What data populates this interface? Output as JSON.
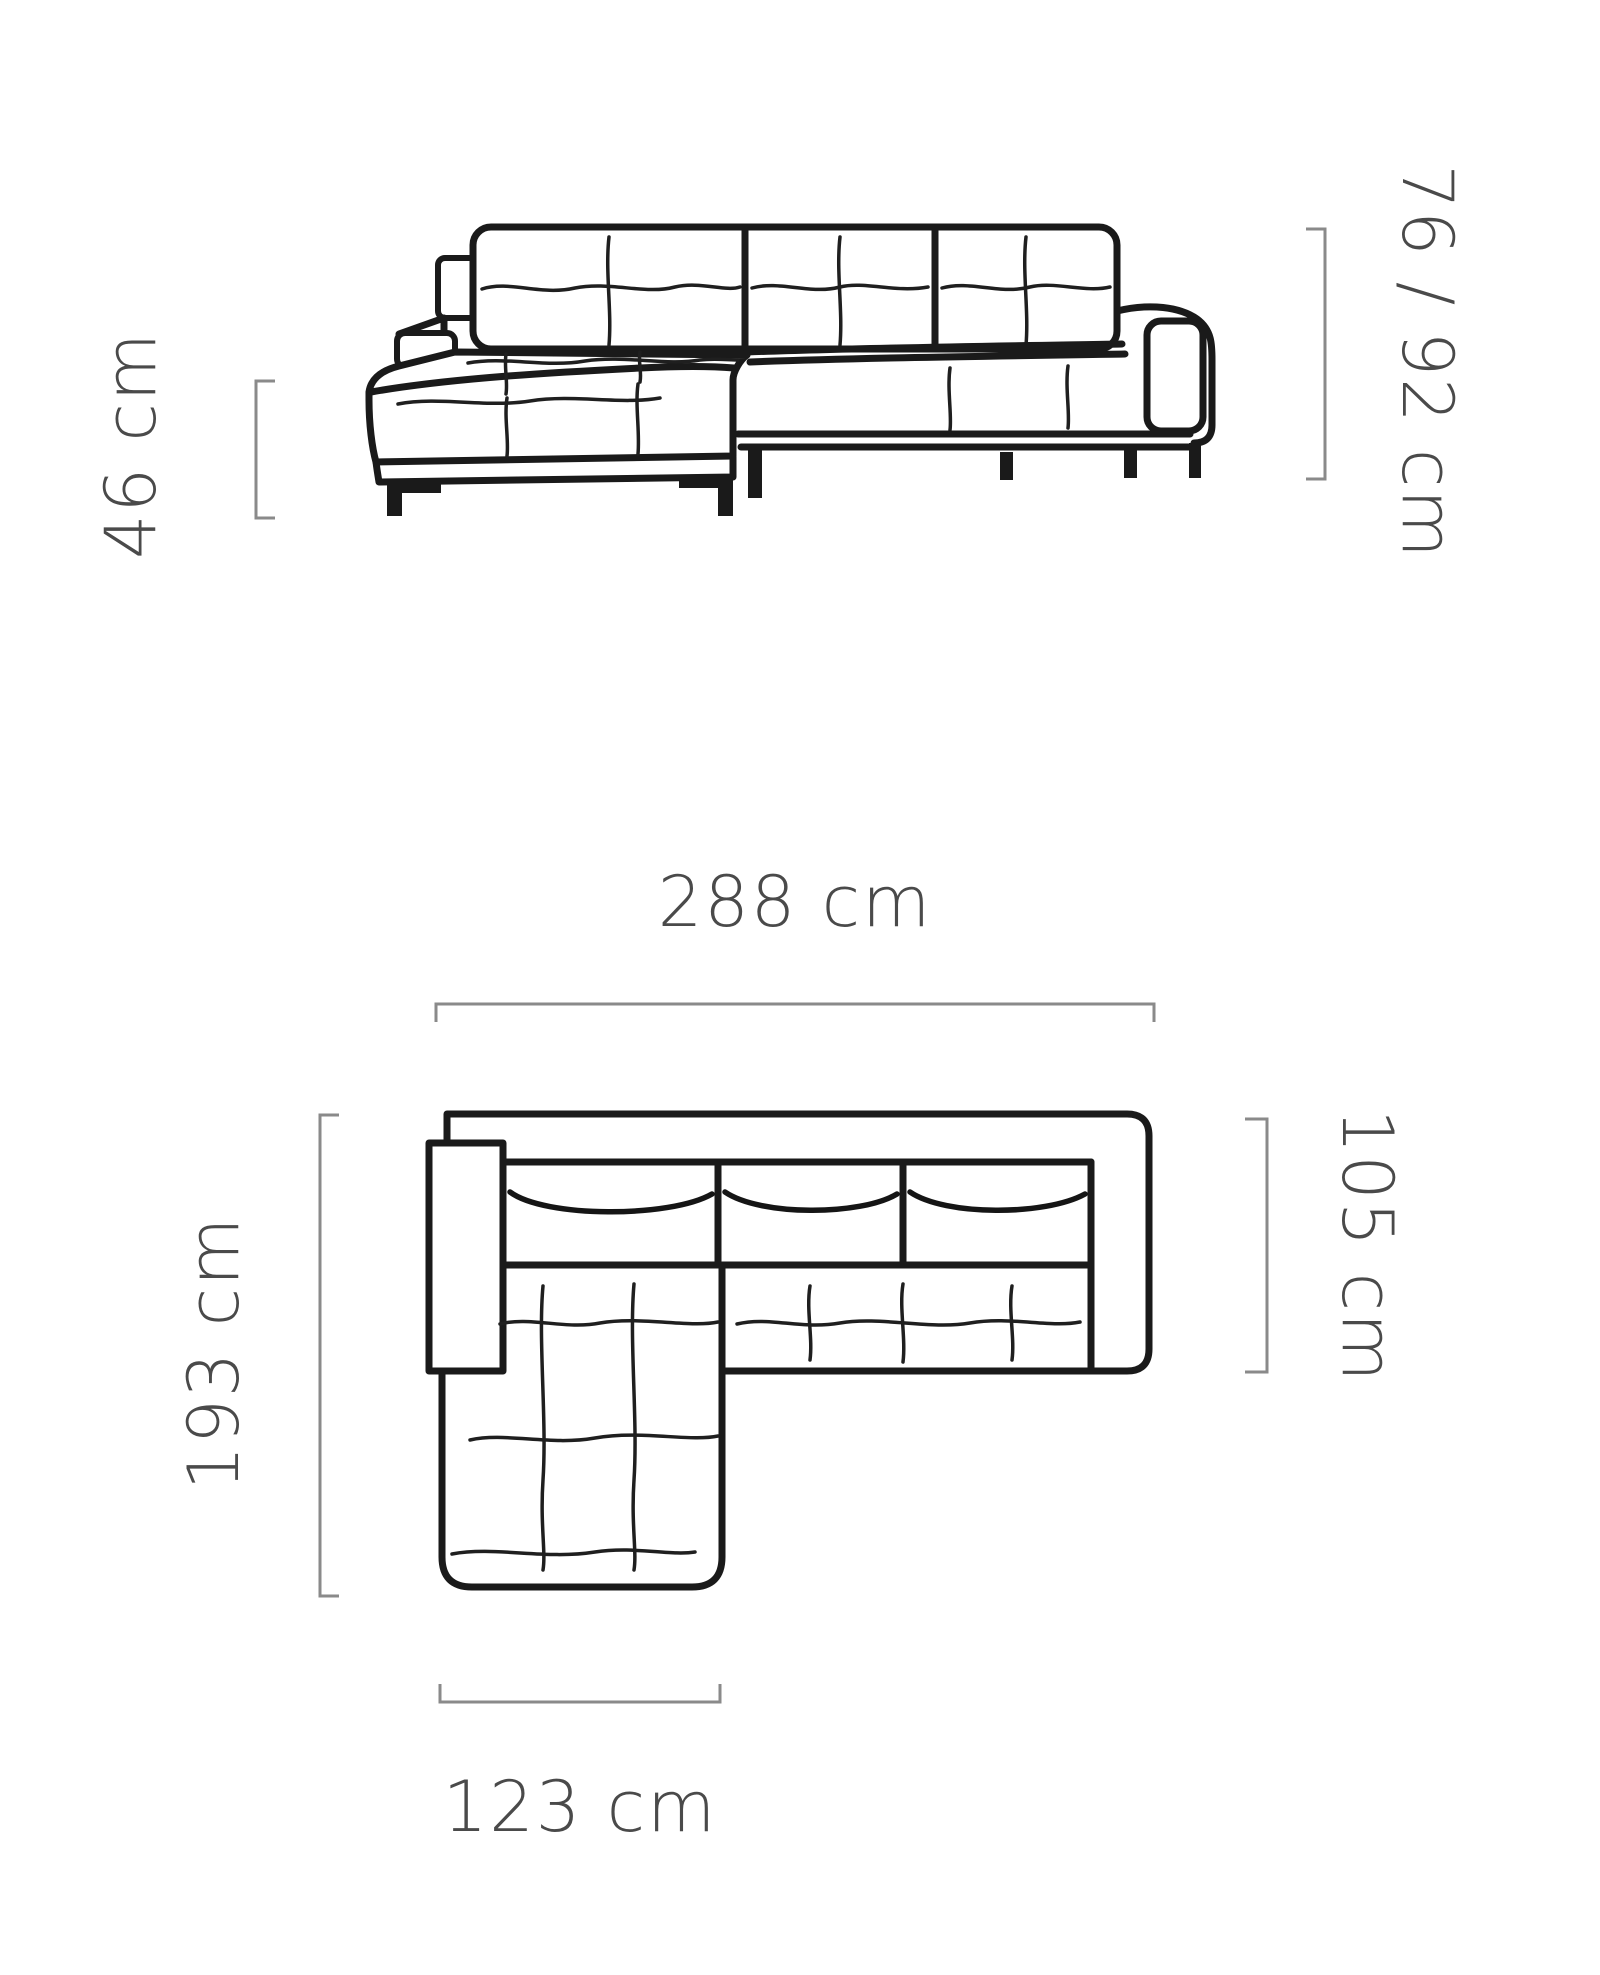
{
  "diagram": {
    "title": "Corner sofa dimension diagram",
    "views": {
      "front_view": "sofa front view drawing",
      "top_view": "sofa top (plan) view drawing"
    },
    "labels": {
      "seat_height": "46 cm",
      "total_height": "76 / 92 cm",
      "total_width": "288 cm",
      "total_depth": "193 cm",
      "sofa_depth": "105 cm",
      "chaise_width": "123 cm"
    },
    "colors": {
      "background": "#ffffff",
      "drawing_line": "#1a1a1a",
      "dimension_bracket": "#8a8a8a",
      "dimension_text": "#4a4a4a"
    }
  }
}
